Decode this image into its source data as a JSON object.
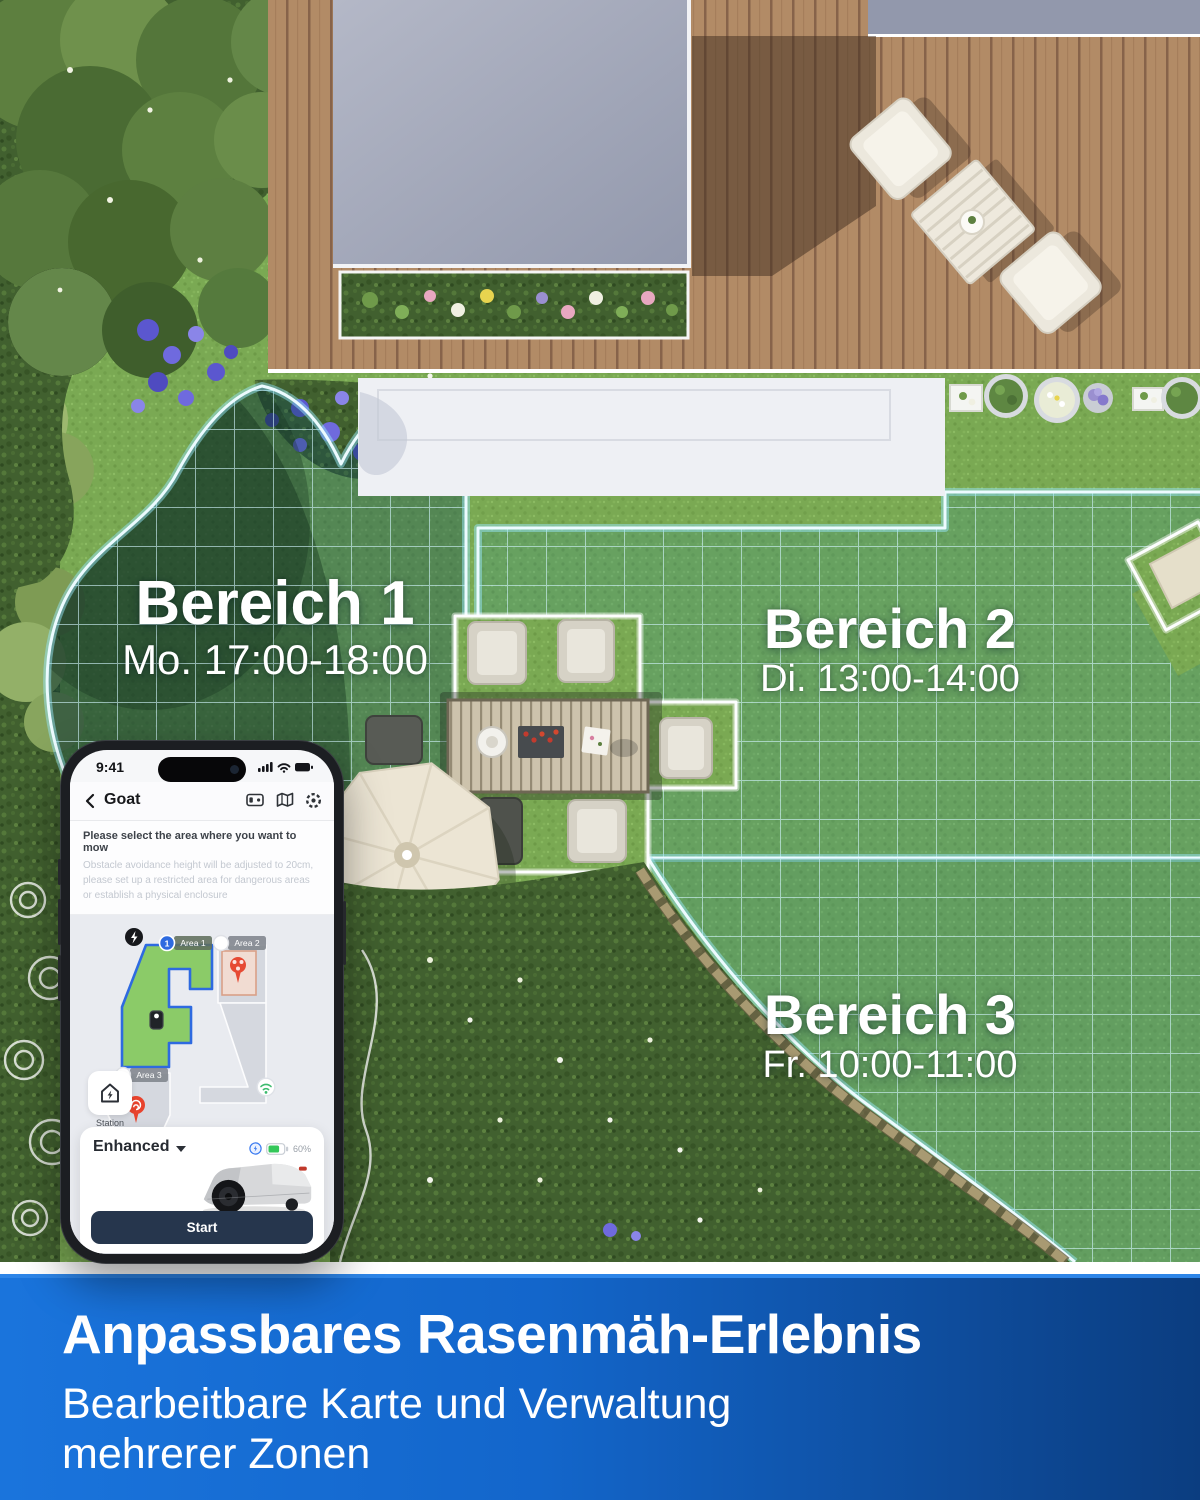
{
  "zones": [
    {
      "name": "Bereich 1",
      "schedule": "Mo. 17:00-18:00"
    },
    {
      "name": "Bereich 2",
      "schedule": "Di. 13:00-14:00"
    },
    {
      "name": "Bereich 3",
      "schedule": "Fr. 10:00-11:00"
    }
  ],
  "phone": {
    "status_time": "9:41",
    "nav": {
      "title": "Goat"
    },
    "instruction": {
      "title": "Please select the area where you want to mow",
      "body": "Obstacle avoidance height will be adjusted to 20cm, please set up a restricted area for dangerous areas or establish a physical enclosure"
    },
    "map": {
      "area1_index": "1",
      "area1": "Area 1",
      "area2": "Area 2",
      "area3": "Area 3"
    },
    "station_label": "Station",
    "mode": {
      "label": "Enhanced",
      "battery": "60%"
    },
    "start_label": "Start"
  },
  "banner": {
    "title": "Anpassbares Rasenmäh-Erlebnis",
    "subtitle_line1": "Bearbeitbare Karte und Verwaltung",
    "subtitle_line2": "mehrerer Zonen"
  },
  "icons": {
    "nav": [
      "dock-icon",
      "map-icon",
      "settings-icon"
    ],
    "status": [
      "signal-icon",
      "wifi-icon",
      "battery-icon"
    ]
  },
  "colors": {
    "banner_left": "#1a74dc",
    "banner_right": "#0b3d80",
    "grid_line": "#d0f4fc",
    "area_green": "#8bcb68",
    "area_border_blue": "#2e6ae0",
    "start_button": "#26364d",
    "battery_green": "#34c759"
  }
}
